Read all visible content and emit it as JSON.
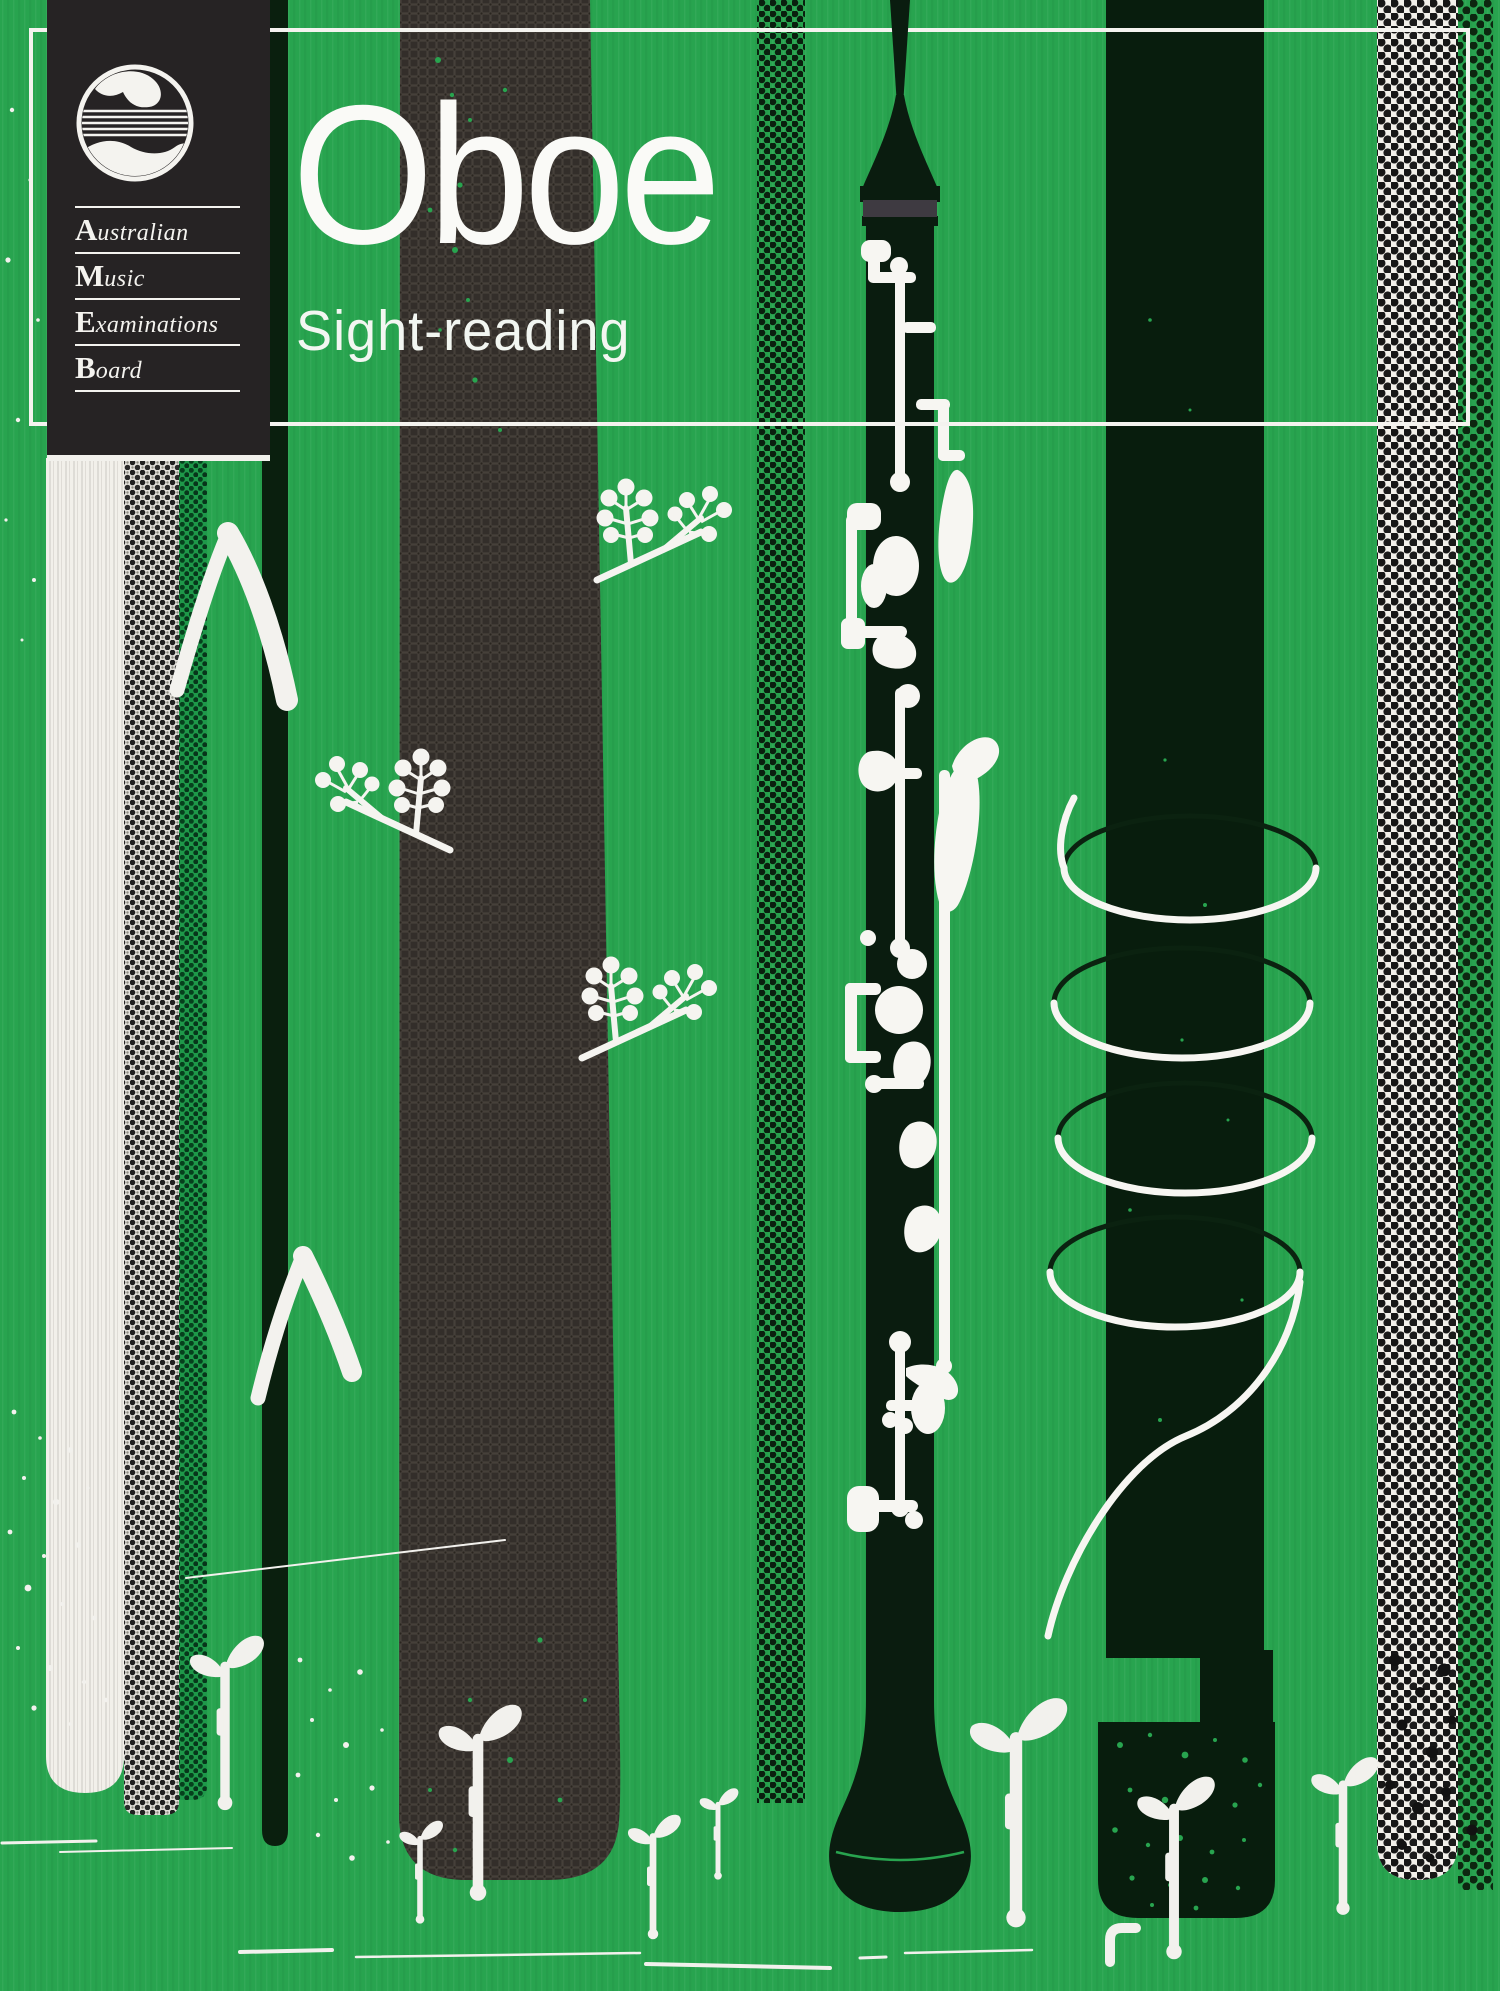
{
  "cover": {
    "title": "Oboe",
    "subtitle": "Sight-reading",
    "publisher": {
      "name_words": [
        {
          "initial": "A",
          "rest": "ustralian"
        },
        {
          "initial": "M",
          "rest": "usic"
        },
        {
          "initial": "E",
          "rest": "xaminations"
        },
        {
          "initial": "B",
          "rest": "oard"
        }
      ],
      "logo_icon": "wave-and-staff-emblem"
    },
    "illustrations": {
      "center": "oboe-instrument",
      "decor": [
        "plant-sprigs",
        "chevron-grass",
        "spiral-coil",
        "seedling-sprouts",
        "halftone-dot-stripes",
        "textured-stripes"
      ]
    },
    "colors": {
      "background_green": "#28A44F",
      "dark_green_stripe": "#0A1F0E",
      "charcoal_stripe": "#332E2A",
      "panel_black": "#262324",
      "off_white": "#F2F1EC",
      "cork_gray": "#3E3A41"
    }
  }
}
